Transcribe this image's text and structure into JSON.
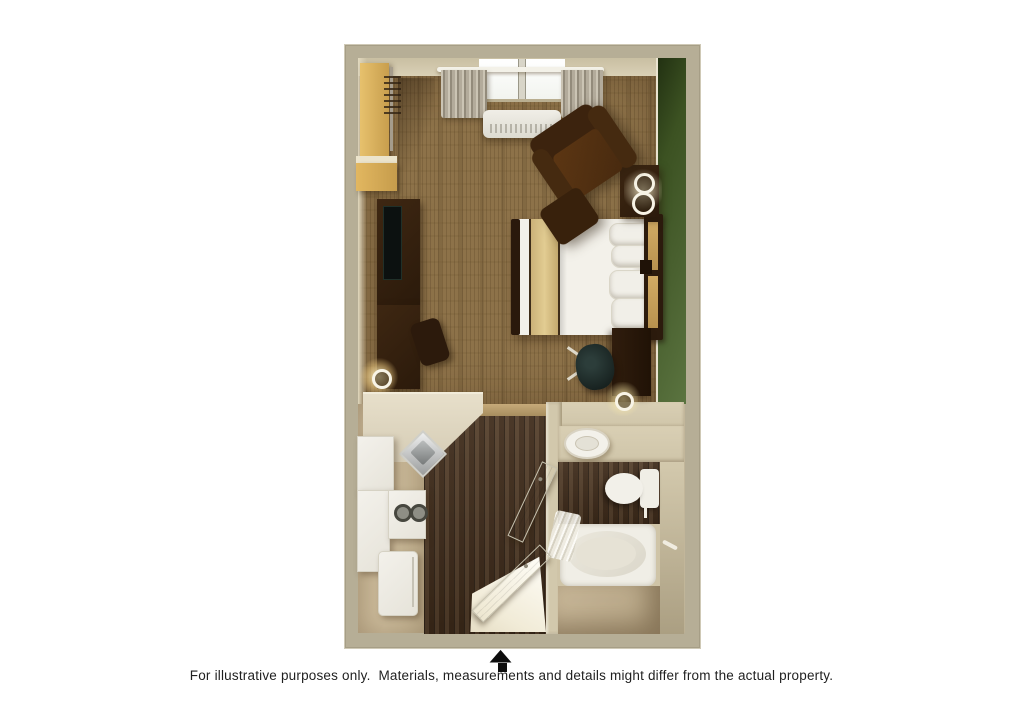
{
  "page": {
    "background_color": "#ffffff",
    "disclaimer_text": "For illustrative purposes only.  Materials, measurements and details might differ from the actual property.",
    "entry_arrow_glyph": "▲"
  },
  "floor_plan": {
    "description": "3D top-down rendering of a studio suite floor plan",
    "rooms": [
      "bedroom-living-area",
      "closet",
      "kitchenette",
      "hallway",
      "bathroom"
    ],
    "colors": {
      "outer_wall": "#b6ae96",
      "inner_wall": "#d8cfb5",
      "accent_wall_green": "#475c2d",
      "carpet": "#8d7249",
      "hardwood": "#46301d",
      "kitchen_floor": "#c8b695",
      "bathroom_floor": "#c2b192",
      "counter": "#dcd4bf",
      "white_fixtures": "#f1efe9",
      "dark_wood_furniture": "#342112",
      "bedding_white": "#f3f1ea",
      "bed_runner_gold": "#d8c084",
      "headboard_panel_tan": "#c7a562",
      "closet_shelf_tan": "#dfb765",
      "arrow_black": "#111111"
    }
  }
}
